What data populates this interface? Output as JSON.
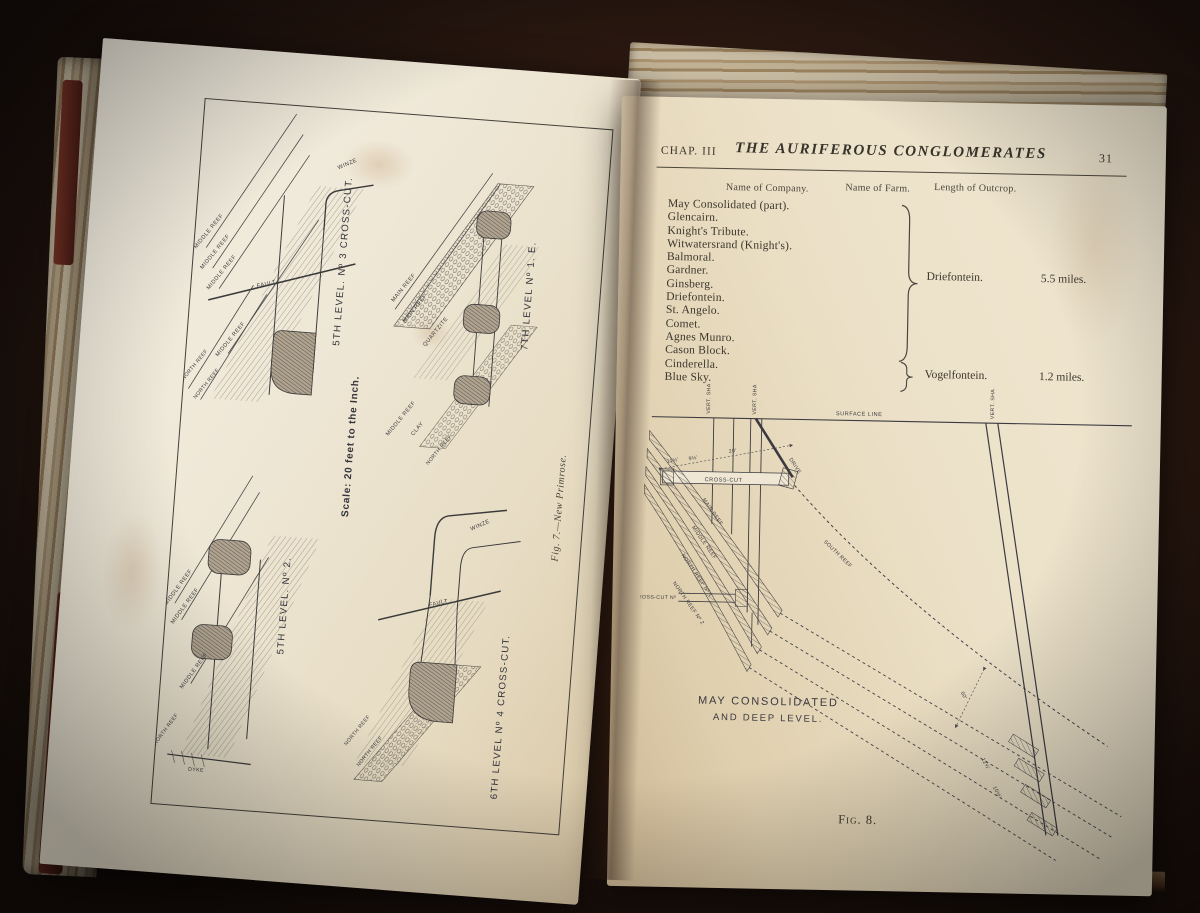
{
  "left_page": {
    "figure_caption": "Fig. 7.—New Primrose.",
    "scale_note": "Scale: 20 feet to the Inch.",
    "captions": {
      "d1": "5TH LEVEL. Nº 3 CROSS-CUT.",
      "d2": "7TH LEVEL Nº 1. E.",
      "d3": "5TH LEVEL. Nº 2.",
      "d4": "6TH LEVEL Nº 4 CROSS-CUT."
    },
    "labels": {
      "middle_reef": "MIDDLE REEF",
      "north_reef": "NORTH REEF",
      "main_reef": "MAIN REEF",
      "quartzite": "QUARTZITE",
      "clay": "CLAY",
      "fault": "FAULT",
      "winze": "WINZE",
      "dyke": "DYKE"
    }
  },
  "right_page": {
    "header": {
      "chapter": "CHAP. III",
      "title": "THE AURIFEROUS CONGLOMERATES",
      "page_number": "31"
    },
    "table": {
      "columns": [
        "Name of Company.",
        "Name of Farm.",
        "Length of Outcrop."
      ],
      "groups": [
        {
          "companies": [
            "May Consolidated (part).",
            "Glencairn.",
            "Knight's Tribute.",
            "Witwatersrand (Knight's).",
            "Balmoral.",
            "Gardner.",
            "Ginsberg.",
            "Driefontein.",
            "St. Angelo.",
            "Comet.",
            "Agnes Munro.",
            "Cason Block."
          ],
          "farm": "Driefontein.",
          "outcrop": "5.5 miles."
        },
        {
          "companies": [
            "Cinderella.",
            "Blue Sky."
          ],
          "farm": "Vogelfontein.",
          "outcrop": "1.2 miles."
        }
      ]
    },
    "figure8": {
      "caption": "Fig. 8.",
      "title_line1": "MAY CONSOLIDATED",
      "title_line2": "AND DEEP LEVEL.",
      "labels": {
        "surface_line": "SURFACE LINE",
        "vert_shaft": "VERT. SHAFT",
        "cross_cut": "CROSS-CUT",
        "cross_cut_no": "CROSS-CUT Nº",
        "drive": "DRIVE",
        "south_reef": "SOUTH REEF",
        "main_reef": "MAIN REEF",
        "middle_reef": "MIDDLE REEF",
        "north_reef_1": "NORTH REEF Nº 1",
        "north_reef_2": "NORTH REEF Nº 2"
      },
      "measurements": {
        "m111": "11½'",
        "m9": "9½'",
        "m20": "20'",
        "m60": "60'",
        "m12": "12½'",
        "m10": "10½'"
      }
    }
  }
}
